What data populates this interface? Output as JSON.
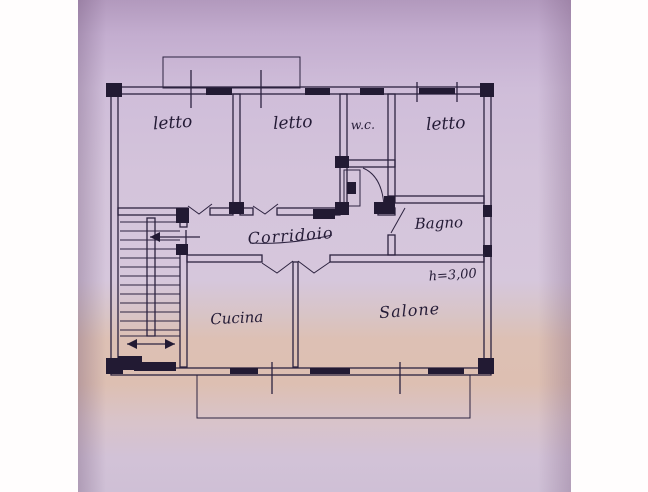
{
  "plan": {
    "rooms": [
      {
        "id": "letto-1",
        "label": "letto"
      },
      {
        "id": "letto-2",
        "label": "letto"
      },
      {
        "id": "wc",
        "label": "w.c."
      },
      {
        "id": "letto-3",
        "label": "letto"
      },
      {
        "id": "corridoio",
        "label": "Corridoio"
      },
      {
        "id": "bagno",
        "label": "Bagno"
      },
      {
        "id": "cucina",
        "label": "Cucina"
      },
      {
        "id": "salone",
        "label": "Salone"
      }
    ],
    "annotations": {
      "ceiling_height": "h=3,00"
    },
    "colors": {
      "ink": "#2d2340",
      "ink_heavy": "#221a33",
      "paper_top": "#b299bd",
      "paper_mid": "#d6c7dc",
      "paper_warm_band": "#ddbfb2",
      "paper_bottom": "#cfc0d6",
      "scan_margin": "#fffdfd"
    }
  }
}
